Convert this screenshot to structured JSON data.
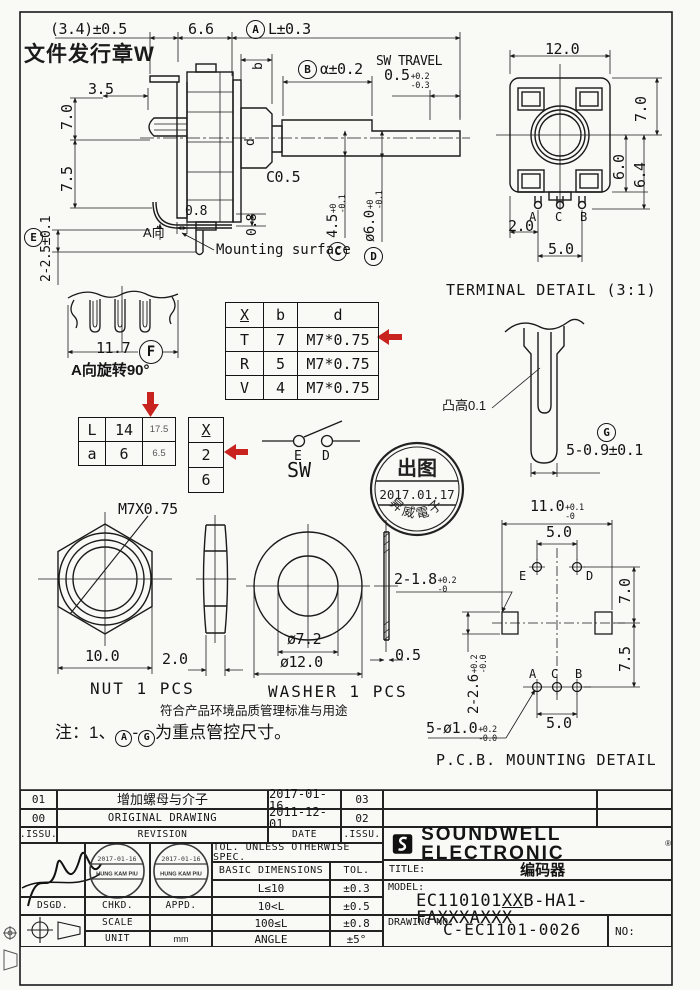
{
  "colors": {
    "accent_red": "#c8231e",
    "line": "#1a1a1a",
    "paper": "#f9f9f6"
  },
  "sheet": {
    "doc_stamp": "文件发行章W"
  },
  "side_view": {
    "dim_3_4": "(3.4)±0.5",
    "dim_6_6": "6.6",
    "ref_a": "A",
    "dim_l": "L±0.3",
    "label_b": "b",
    "ref_b": "B",
    "dim_alpha": "α±0.2",
    "sw_travel_label": "SW TRAVEL",
    "sw_travel_val": "0.5",
    "sw_travel_sup": "+0.2",
    "sw_travel_sub": "-0.3",
    "dim_3_5": "3.5",
    "dim_7_0": "7.0",
    "dim_7_5": "7.5",
    "label_d": "d",
    "dim_c0_5": "C0.5",
    "dim_4_5": "4.5",
    "dim_4_5_sup": "+0",
    "dim_4_5_sub": "-0.1",
    "ref_c": "C",
    "dim_6_0": "ø6.0",
    "dim_6_0_sup": "+0",
    "dim_6_0_sub": "-0.1",
    "ref_d": "D",
    "dim_0_8a": "0.8",
    "dim_0_8b": "0.8",
    "a_dir": "A向",
    "ref_e": "E",
    "dim_2_2_5": "2-2.5±0.1",
    "mounting_surface": "Mounting surface"
  },
  "rear_view": {
    "dim_12": "12.0",
    "dim_7": "7.0",
    "dim_6": "6.0",
    "dim_6_4": "6.4",
    "pin_a": "A",
    "pin_c": "C",
    "pin_b": "B",
    "dim_2": "2.0",
    "dim_5": "5.0"
  },
  "terminal_detail": {
    "title": "TERMINAL DETAIL (3:1)",
    "bump_label": "凸高0.1",
    "ref_g": "G",
    "dim": "5-0.9±0.1"
  },
  "f_view": {
    "dim_11_7": "11.7",
    "ref_f": "F",
    "caption": "A向旋转90°"
  },
  "la_table": {
    "rows": [
      {
        "c1": "L",
        "c2": "14",
        "c3": "17.5"
      },
      {
        "c1": "a",
        "c2": "6",
        "c3": "6.5"
      }
    ]
  },
  "x_table": {
    "header": "X",
    "r1": "2",
    "r2": "6"
  },
  "xbd_table": {
    "h1": "X",
    "h2": "b",
    "h3": "d",
    "rows": [
      {
        "x": "T",
        "b": "7",
        "d": "M7*0.75"
      },
      {
        "x": "R",
        "b": "5",
        "d": "M7*0.75"
      },
      {
        "x": "V",
        "b": "4",
        "d": "M7*0.75"
      }
    ]
  },
  "sw_symbol": {
    "e": "E",
    "d": "D",
    "label": "SW"
  },
  "release_stamp": {
    "top": "出图",
    "date": "2017.01.17",
    "bottom": "昇威電子"
  },
  "nut": {
    "thread": "M7X0.75",
    "dim_10": "10.0",
    "dim_2": "2.0",
    "caption": "NUT 1 PCS"
  },
  "washer": {
    "dim_inner": "ø7.2",
    "dim_outer": "ø12.0",
    "dim_thick": "0.5",
    "caption": "WASHER 1 PCS"
  },
  "pcb": {
    "dim_11": "11.0",
    "dim_11_sup": "+0.1",
    "dim_11_sub": "-0",
    "dim_5_top": "5.0",
    "hole_e": "E",
    "hole_d": "D",
    "dim_1_8": "2-1.8",
    "dim_1_8_sup": "+0.2",
    "dim_1_8_sub": "-0",
    "dim_7": "7.0",
    "dim_7_5": "7.5",
    "dim_2_6": "2-2.6",
    "dim_2_6_sup": "+0.2",
    "dim_2_6_sub": "-0.0",
    "hole_a": "A",
    "hole_c": "C",
    "hole_b": "B",
    "dim_5_bot": "5.0",
    "dim_holes": "5-ø1.0",
    "dim_holes_sup": "+0.2",
    "dim_holes_sub": "-0.0",
    "caption": "P.C.B. MOUNTING DETAIL"
  },
  "notes": {
    "env_note": "符合产品环境品质管理标准与用途",
    "note_prefix": "注：1、",
    "ref_a": "A",
    "dash": "-",
    "ref_g": "G",
    "note_suffix": "为重点管控尺寸。"
  },
  "title_block": {
    "revisions": [
      {
        "issu": "01",
        "desc": "增加螺母与介子",
        "date": "2017-01-16",
        "issu2": "03"
      },
      {
        "issu": "00",
        "desc": "ORIGINAL DRAWING",
        "date": "2011-12-01",
        "issu2": "02"
      }
    ],
    "header": {
      "issu": ".ISSU.",
      "revision": "REVISION",
      "date": "DATE",
      "issu2": ".ISSU."
    },
    "company": "SOUNDWELL ELECTRONIC",
    "tol_title": "TOL. UNLESS OTHERWISE SPEC.",
    "tol_col1": "BASIC DIMENSIONS",
    "tol_col2": "TOL.",
    "tol_rows": [
      {
        "dim": "L≤10",
        "tol": "±0.3"
      },
      {
        "dim": "10<L",
        "tol": "±0.5"
      },
      {
        "dim": "100≤L",
        "tol": "±0.8"
      },
      {
        "dim": "ANGLE",
        "tol": "±5°"
      }
    ],
    "dsgd": "DSGD.",
    "chkd": "CHKD.",
    "appd": "APPD.",
    "scale": "SCALE",
    "unit": "UNIT",
    "unit_value": "mm",
    "stamp_name": "HUNG KAM PIU",
    "stamp_date": "2017-01-16",
    "title_label": "TITLE:",
    "title_value": "编码器",
    "model_label": "MODEL:",
    "model_pre": "EC110101",
    "model_mid": "XX",
    "model_post": "B-HA1-FAXXXAXXX",
    "drawing_label": "DRAWING NO:",
    "drawing_value": "C-EC1101-0026",
    "no_label": "NO:"
  }
}
